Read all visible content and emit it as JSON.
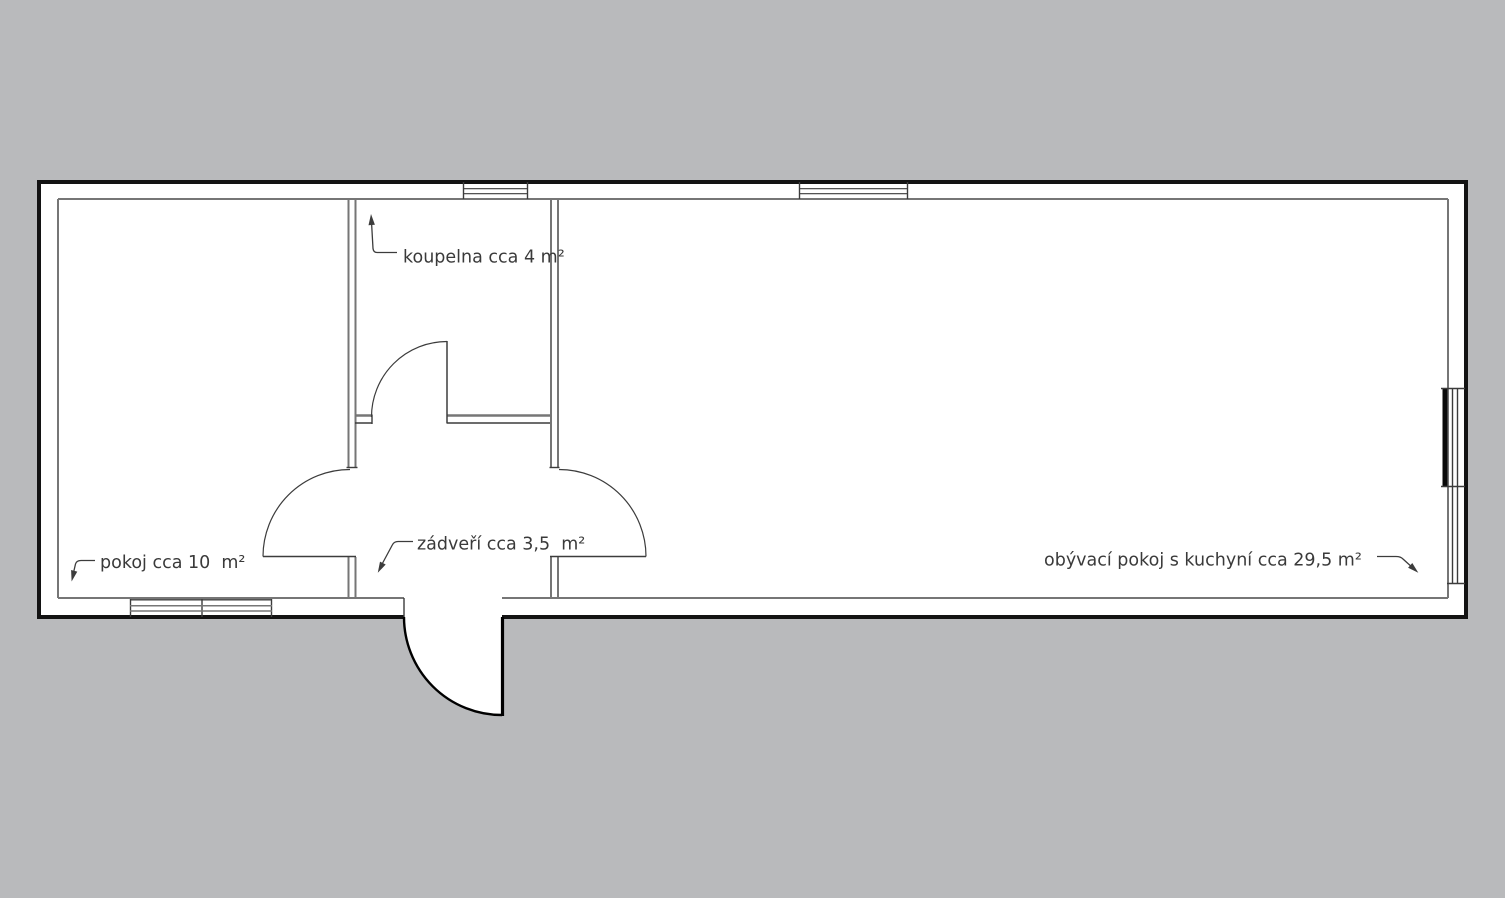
{
  "plan": {
    "type": "apartment-floor-plan",
    "labels": {
      "bathroom": "koupelna cca 4 m²",
      "hallway": "zádveří cca 3,5  m²",
      "bedroom": "pokoj cca 10  m²",
      "living": "obývací pokoj s kuchyní cca 29,5 m²"
    }
  },
  "colors": {
    "outside": "#b9babc",
    "floor": "#ffffff",
    "outer-wall": "#131313",
    "inner-wall": "#767676",
    "detail": "#3c3c3c",
    "text": "#3a3a3a"
  }
}
